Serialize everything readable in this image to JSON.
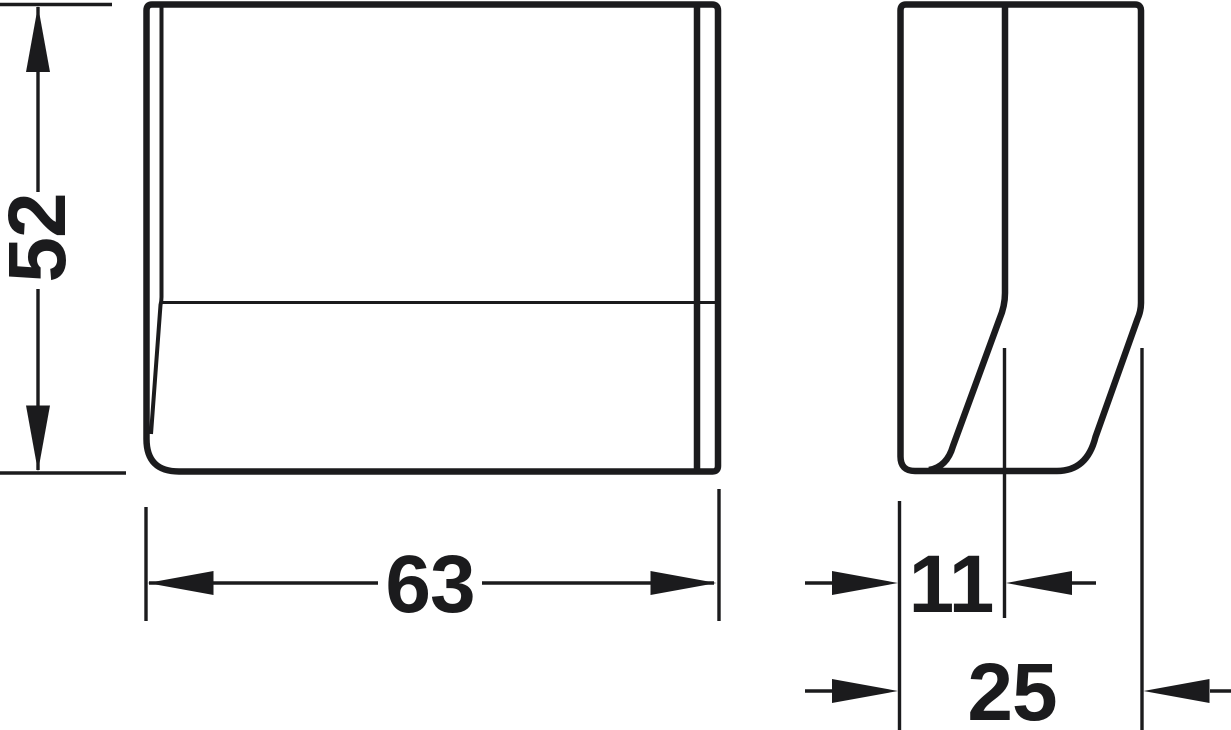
{
  "colors": {
    "background": "#ffffff",
    "line": "#1b1b1d"
  },
  "drawing": {
    "type": "technical-dimension-drawing",
    "views": [
      "front-view",
      "side-profile-view"
    ]
  },
  "dimensions": {
    "height": "52",
    "width": "63",
    "recess_depth": "11",
    "total_depth": "25"
  }
}
